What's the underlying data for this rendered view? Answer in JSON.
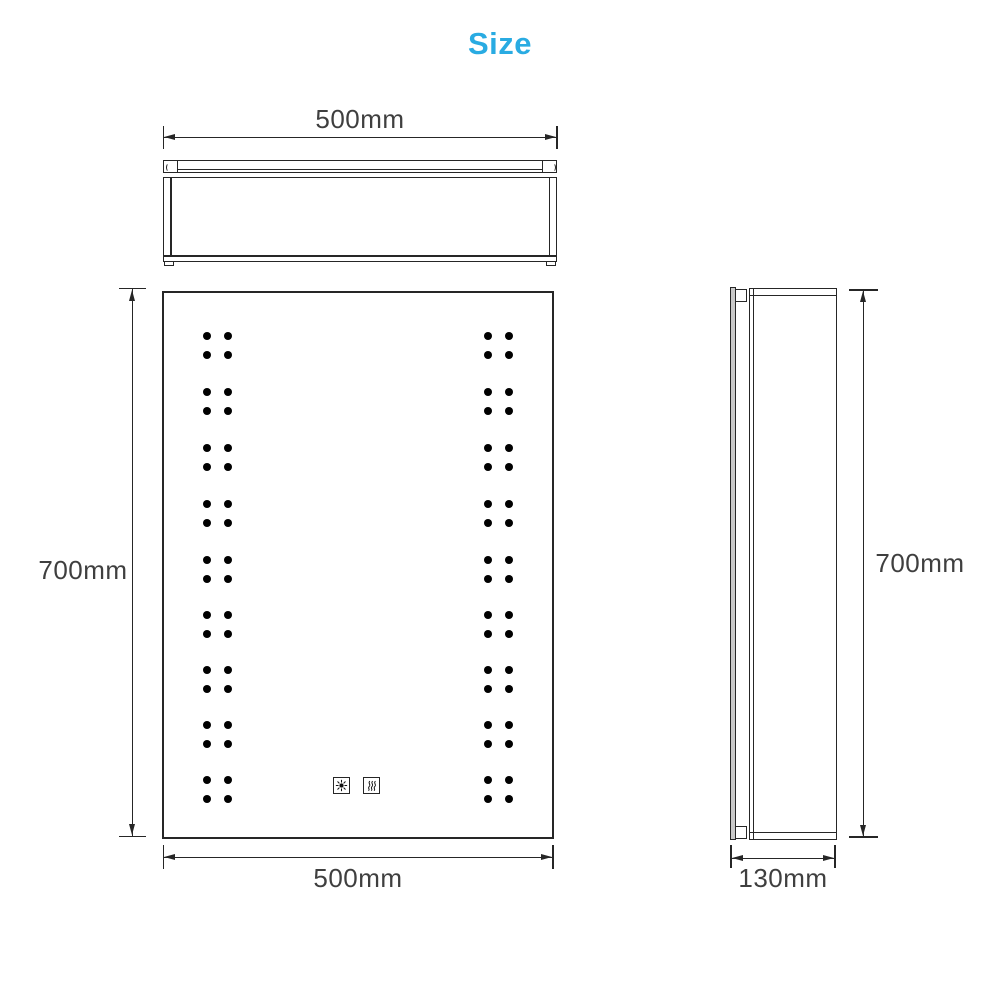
{
  "title": {
    "text": "Size",
    "color": "#29abe2"
  },
  "views": {
    "front_view": {
      "led_dots": {
        "group_start_ys": [
          336,
          392,
          448,
          504,
          560,
          615,
          670,
          725,
          780
        ],
        "row_offset": 19,
        "left_column_xs": [
          207,
          228
        ],
        "right_column_xs": [
          488,
          509
        ],
        "dot_diameter": 8
      },
      "touch_icons": [
        {
          "name": "light-touch-button"
        },
        {
          "name": "demister-touch-button"
        }
      ]
    }
  },
  "dimensions": {
    "top_width": "500mm",
    "front_width": "500mm",
    "front_height": "700mm",
    "side_height": "700mm",
    "side_depth": "130mm"
  },
  "colors": {
    "accent": "#29abe2",
    "line": "#262626",
    "dimension_text": "#3f3f3f",
    "dot": "#000000",
    "mirror_edge_fill": "#c9c9c9"
  }
}
